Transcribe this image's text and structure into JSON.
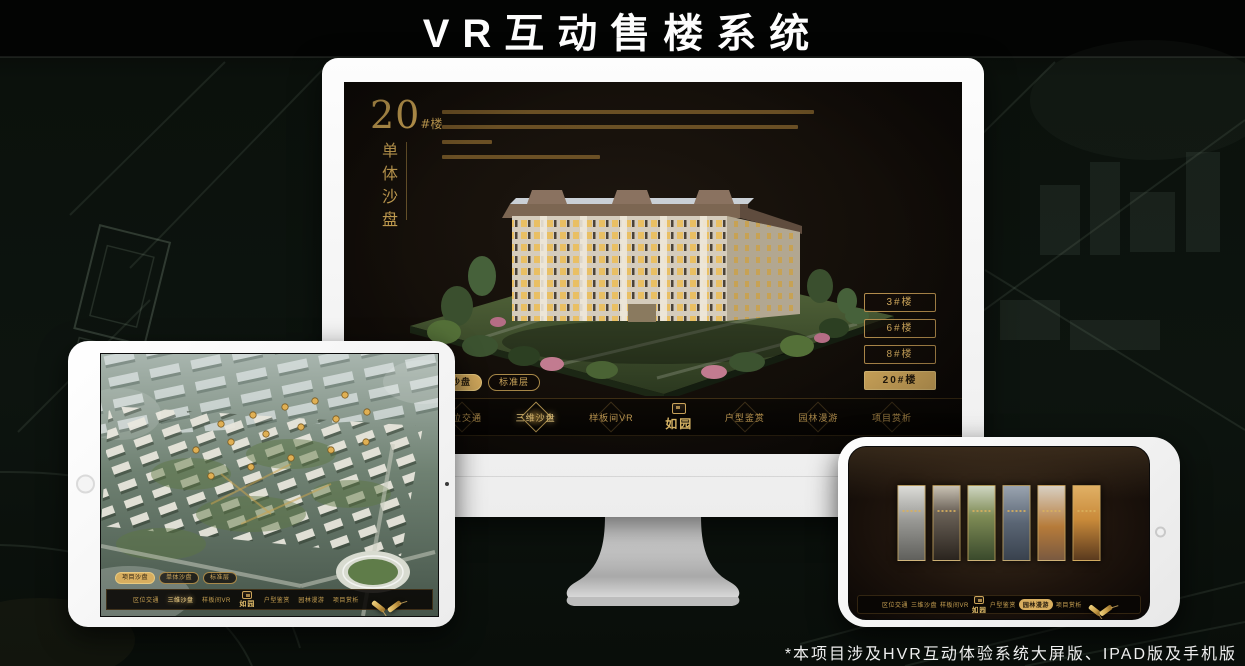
{
  "page": {
    "title": "VR互动售楼系统",
    "footnote": "*本项目涉及HVR互动体验系统大屏版、IPAD版及手机版"
  },
  "colors": {
    "gold": "#C9A253",
    "gold_bright": "#F2D287",
    "active_tab_bg": "#D8AE5F",
    "screen_bg": "#130E09",
    "page_bg": "#0D140F"
  },
  "monitor": {
    "building_title": {
      "number": "20",
      "unit": "#楼",
      "subtitle_vertical": "单体沙盘"
    },
    "floor_buttons": [
      {
        "label": "3#楼",
        "active": false
      },
      {
        "label": "6#楼",
        "active": false
      },
      {
        "label": "8#楼",
        "active": false
      },
      {
        "label": "20#楼",
        "active": true
      }
    ],
    "sub_tabs": [
      {
        "label": "项目沙盘",
        "active": false
      },
      {
        "label": "单体沙盘",
        "active": true
      },
      {
        "label": "标准层",
        "active": false
      }
    ],
    "nav": {
      "items": [
        {
          "label": "区位交通",
          "active": false
        },
        {
          "label": "三维沙盘",
          "active": true
        },
        {
          "label": "样板间VR",
          "active": false
        },
        {
          "label": "户型鉴赏",
          "active": false
        },
        {
          "label": "园林漫游",
          "active": false
        },
        {
          "label": "项目赏析",
          "active": false
        }
      ],
      "logo": "如园"
    }
  },
  "tablet": {
    "sub_tabs": [
      {
        "label": "项目沙盘",
        "active": true
      },
      {
        "label": "单体沙盘",
        "active": false
      },
      {
        "label": "标准层",
        "active": false
      }
    ],
    "nav": {
      "items": [
        {
          "label": "区位交通",
          "active": false
        },
        {
          "label": "三维沙盘",
          "active": true
        },
        {
          "label": "样板间VR",
          "active": false
        },
        {
          "label": "户型鉴赏",
          "active": false
        },
        {
          "label": "园林漫游",
          "active": false
        },
        {
          "label": "项目赏析",
          "active": false
        }
      ],
      "logo": "如园"
    }
  },
  "phone": {
    "nav": {
      "items": [
        {
          "label": "区位交通",
          "active": false
        },
        {
          "label": "三维沙盘",
          "active": false
        },
        {
          "label": "样板间VR",
          "active": false
        },
        {
          "label": "户型鉴赏",
          "active": false
        },
        {
          "label": "园林漫游",
          "active": true
        },
        {
          "label": "项目赏析",
          "active": false
        }
      ],
      "logo": "如园"
    },
    "gallery_count": 6
  }
}
